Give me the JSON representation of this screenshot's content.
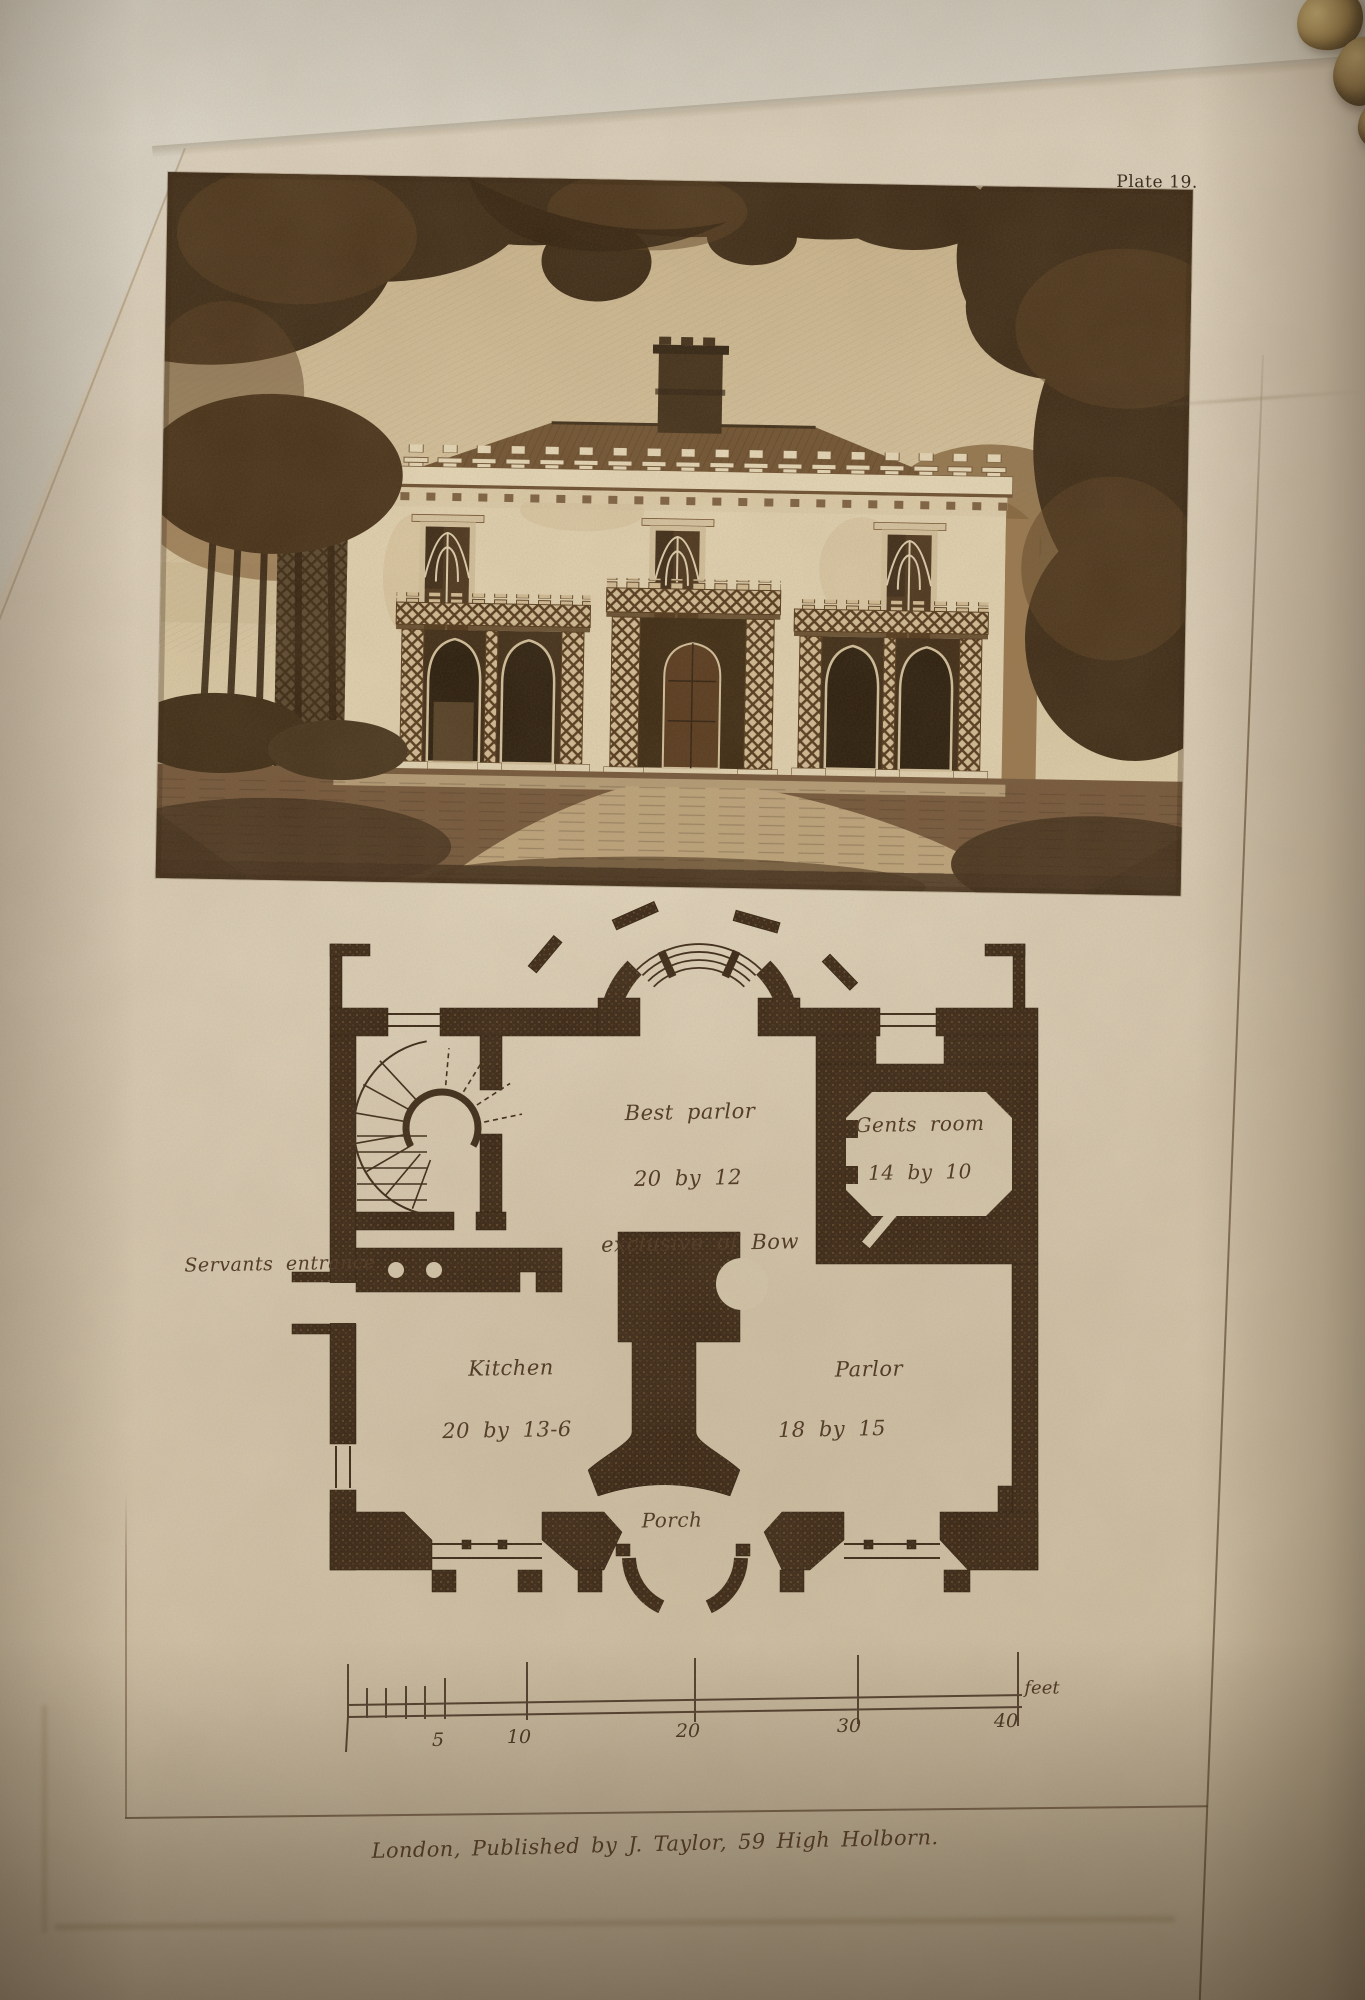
{
  "page": {
    "plate_number": "Plate 19.",
    "imprint": "London, Published by J. Taylor, 59 High Holborn."
  },
  "plan": {
    "rooms": [
      {
        "name": "Best parlor",
        "dims": "20 by 12",
        "note": "exclusive of Bow"
      },
      {
        "name": "Gents room",
        "dims": "14 by 10"
      },
      {
        "name": "Kitchen",
        "dims": "20 by 13-6"
      },
      {
        "name": "Parlor",
        "dims": "18 by 15"
      }
    ],
    "annotations": {
      "servants_entrance": "Servants entrance",
      "porch": "Porch"
    }
  },
  "scale_bar": {
    "tick_labels": [
      "5",
      "10",
      "20",
      "30",
      "40"
    ],
    "unit_label": "feet"
  },
  "colors": {
    "paper": "#d6c9b2",
    "ink": "#382514",
    "engraving_dark": "#382613",
    "brass": "#9c7d44"
  }
}
